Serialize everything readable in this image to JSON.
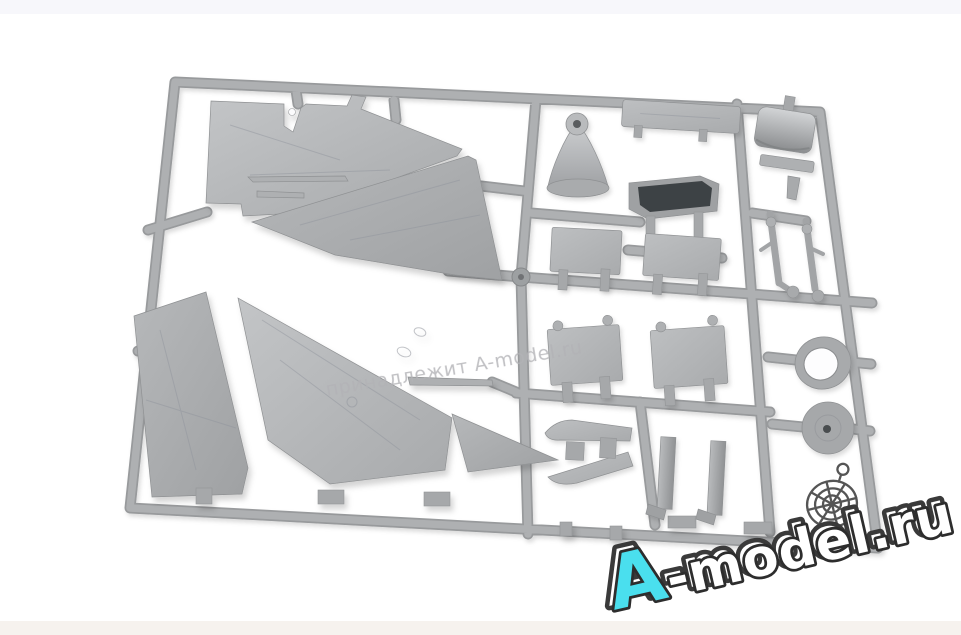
{
  "photo": {
    "alt": "Light grey injection-moulded plastic sprue of an aircraft model kit on a white background: four large delta-wing and fin halves on the left, smaller parts (nose shock-cone, fuselage beam, air-intake tub, flat panels, tailplanes, landing-gear struts, canopy section, tyre ring, wheel disc, gear doors, probes) held in a grid of runners on the right",
    "background_color": "#ffffff",
    "top_strip_color": "#f7f7fb",
    "bottom_strip_color": "#f6f2ee"
  },
  "sprue": {
    "plastic_color": "#b2b4b6",
    "plastic_highlight": "#c8cacc",
    "plastic_shadow": "#8e9092",
    "runner_color": "#aeb0b2",
    "runner_edge_color": "#989a9c",
    "intake_opening_color": "#3e4245",
    "parts": [
      "delta-wing-half-upper",
      "delta-wing-half-mid",
      "tail-fin-half",
      "delta-wing-half-lower-left",
      "delta-wing-half-lower-right",
      "nose-shock-cone",
      "fuselage-beam",
      "air-intake-tub",
      "flat-panel-left",
      "flat-panel-right",
      "tailplane-left",
      "tailplane-right",
      "canopy-section",
      "saddle-strip",
      "landing-gear-strut-front",
      "landing-gear-strut-rear",
      "tyre-ring",
      "wheel-disc",
      "curved-lip-upper",
      "curved-lip-lower",
      "gear-door-left",
      "gear-door-right",
      "pitot-probe",
      "actuator-rod"
    ]
  },
  "watermarks": {
    "center": {
      "text": "принадлежит A-model.ru",
      "color": "#b2b2b6"
    },
    "logo": {
      "letter": "A",
      "rest": "-model.ru",
      "letter_color": "#4adfee",
      "text_fill": "#ffffff",
      "outline_color": "#2d2d2d",
      "icon": "spider-web-icon",
      "icon_color": "#4b4b4b"
    }
  }
}
